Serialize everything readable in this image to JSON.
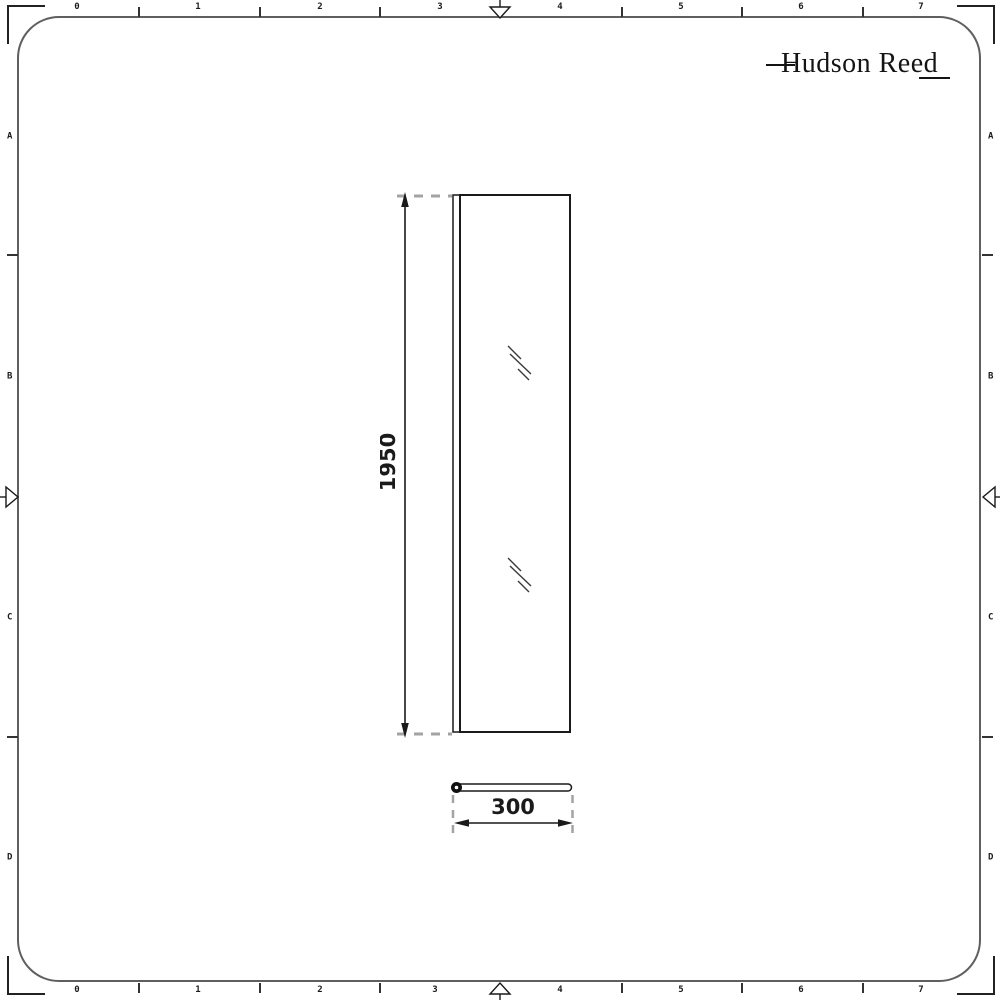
{
  "brand": {
    "name": "Hudson Reed"
  },
  "ruler": {
    "top": [
      "0",
      "1",
      "2",
      "3",
      "4",
      "5",
      "6",
      "7"
    ],
    "bottom": [
      "0",
      "1",
      "2",
      "3",
      "4",
      "5",
      "6",
      "7"
    ],
    "left": [
      "A",
      "B",
      "C",
      "D"
    ],
    "right": [
      "A",
      "B",
      "C",
      "D"
    ]
  },
  "dimensions": {
    "height_mm": "1950",
    "width_mm": "300"
  },
  "icons": {
    "centering_marks": "open-triangle-arrows at mid top/bottom/left/right edges",
    "glass_hatch": "double diagonal reflection strokes on glass panel",
    "corner_marks": "L-shaped registration brackets"
  },
  "colors": {
    "ink": "#1a1a1a",
    "frame": "#5f5f5f",
    "extension_dash": "#a3a3a3",
    "background": "#ffffff"
  }
}
